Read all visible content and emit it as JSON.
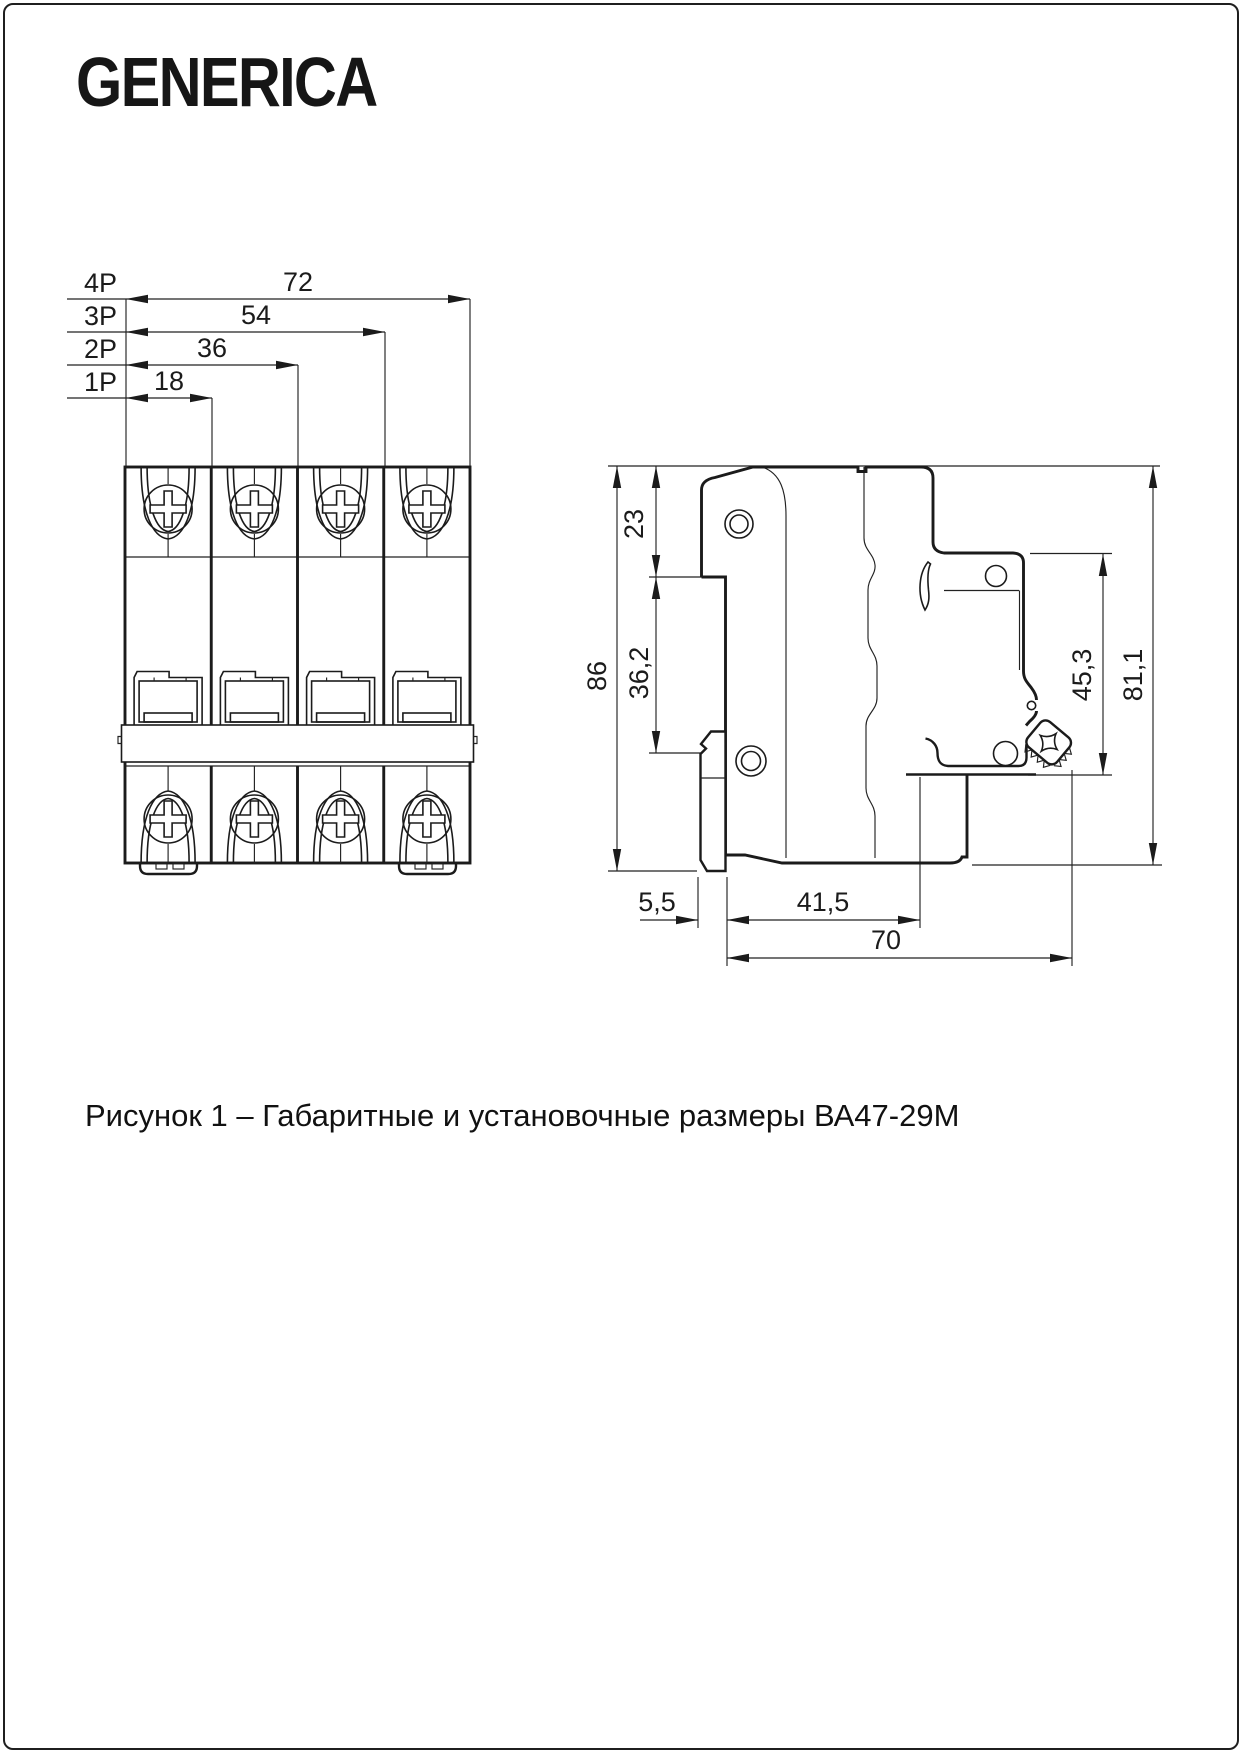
{
  "brand": {
    "logo_text": "GENERICA"
  },
  "figure": {
    "caption": "Рисунок 1 – Габаритные и установочные размеры ВА47-29М"
  },
  "front_view": {
    "pole_rows": [
      {
        "label": "4P",
        "value": "72"
      },
      {
        "label": "3P",
        "value": "54"
      },
      {
        "label": "2P",
        "value": "36"
      },
      {
        "label": "1P",
        "value": "18"
      }
    ]
  },
  "side_view": {
    "dim_height_front": "23",
    "dim_height_total": "86",
    "dim_height_din": "36,2",
    "dim_depth_upper": "45,3",
    "dim_depth_overall": "81,1",
    "dim_clip_protrusion": "5,5",
    "dim_depth_body": "41,5",
    "dim_depth_total": "70"
  }
}
